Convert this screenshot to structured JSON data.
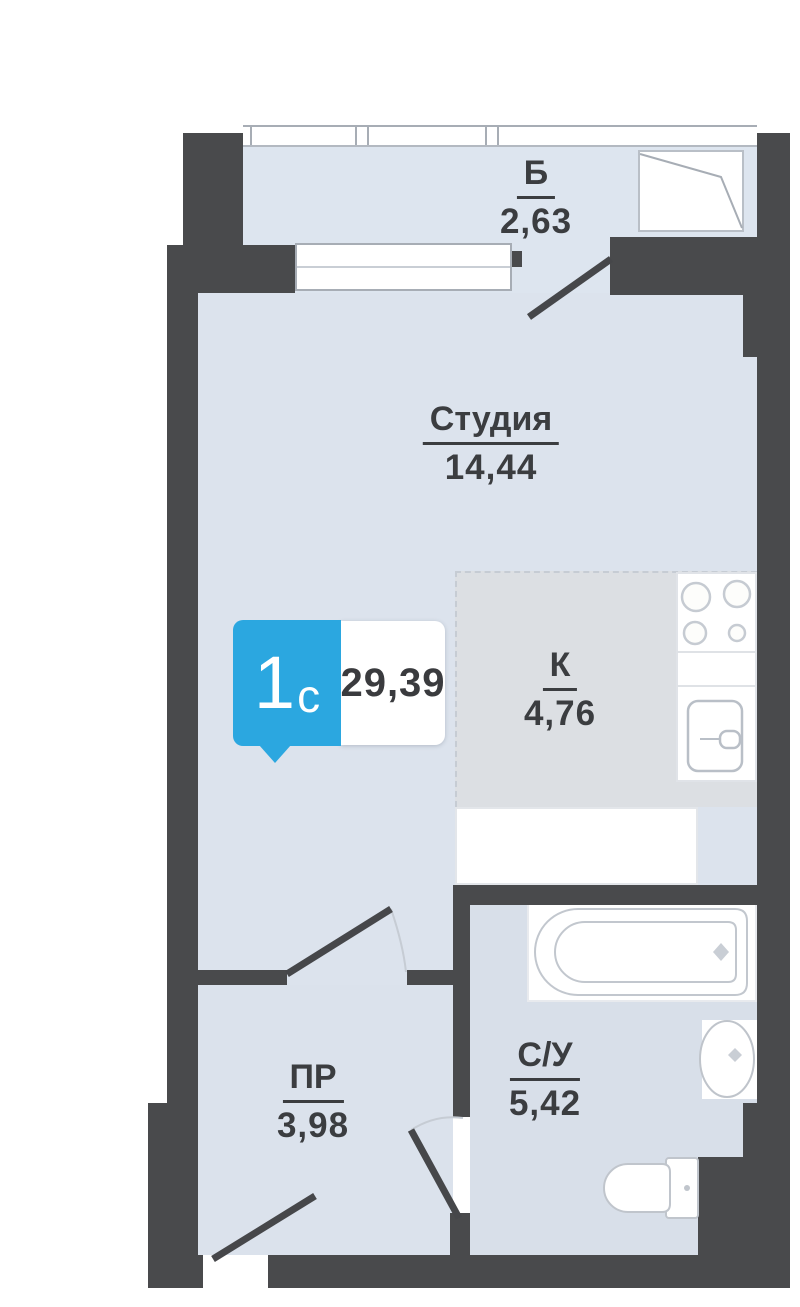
{
  "plan": {
    "title": "Studio apartment floor plan",
    "unit_badge": {
      "type_number": "1",
      "type_letter": "с",
      "total_area": "29,39"
    },
    "rooms": [
      {
        "id": "balcony",
        "label": "Б",
        "area": "2,63"
      },
      {
        "id": "studio",
        "label": "Студия",
        "area": "14,44"
      },
      {
        "id": "kitchen",
        "label": "К",
        "area": "4,76"
      },
      {
        "id": "hallway",
        "label": "ПР",
        "area": "3,98"
      },
      {
        "id": "bathroom",
        "label": "С/У",
        "area": "5,42"
      }
    ]
  },
  "colors": {
    "wall": "#494a4c",
    "floor_main": "#dce3ed",
    "floor_balcony": "#dde5ef",
    "floor_bath": "#d8dfe9",
    "floor_hall": "#dbe2ec",
    "floor_kitchen": "#dcdfe3",
    "fixture_line": "#c2c7ce",
    "fixture_line_strong": "#b9bfc7",
    "glazing_line": "#a7adb5",
    "badge_blue": "#2ba7e0",
    "text": "#3b3d40",
    "white": "#ffffff"
  }
}
